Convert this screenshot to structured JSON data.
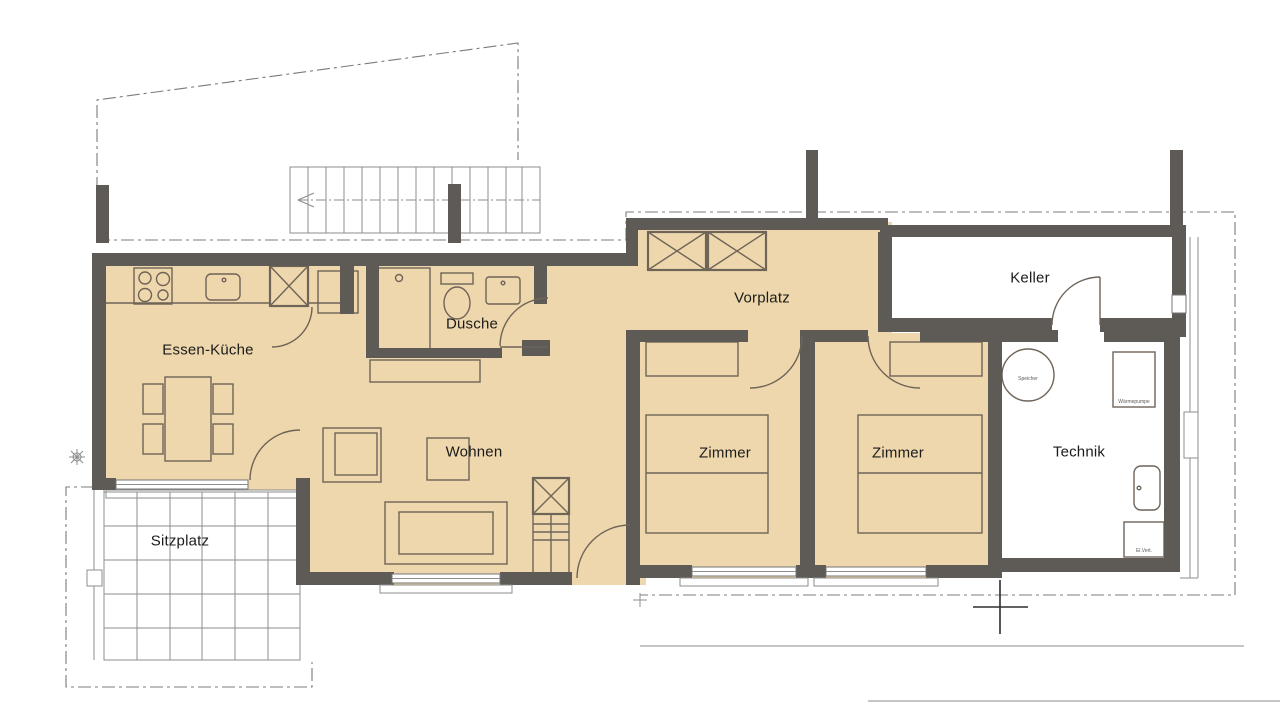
{
  "colors": {
    "wall": "#5e5b57",
    "room_fill": "#eed7ac",
    "line": "#6f6458",
    "thin_line": "#8d8d8d",
    "text": "#1b1b1b"
  },
  "rooms": [
    {
      "id": "essen-kueche",
      "label": "Essen-Küche"
    },
    {
      "id": "dusche",
      "label": "Dusche"
    },
    {
      "id": "wohnen",
      "label": "Wohnen"
    },
    {
      "id": "vorplatz",
      "label": "Vorplatz"
    },
    {
      "id": "zimmer-1",
      "label": "Zimmer"
    },
    {
      "id": "zimmer-2",
      "label": "Zimmer"
    },
    {
      "id": "keller",
      "label": "Keller"
    },
    {
      "id": "technik",
      "label": "Technik"
    },
    {
      "id": "sitzplatz",
      "label": "Sitzplatz"
    }
  ],
  "technik_fixtures": {
    "tank": "Speicher",
    "heat_pump": "Wärmepumpe",
    "panel": "El.Vert."
  }
}
